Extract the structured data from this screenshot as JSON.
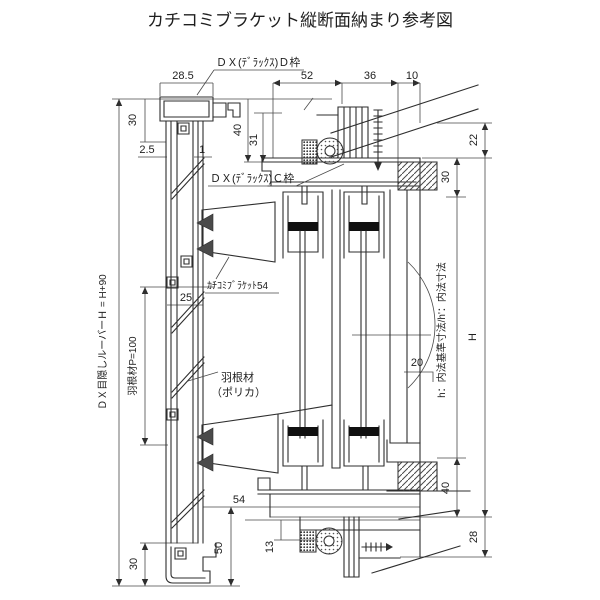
{
  "title": "カチコミブラケット縦断面納まり参考図",
  "colors": {
    "background": "#ffffff",
    "line": "#2e2e2e"
  },
  "labels": {
    "d_frame": "ＤＸ(ﾃﾞﾗｯｸｽ)Ｄ枠",
    "c_frame": "ＤＸ(ﾃﾞﾗｯｸｽ)Ｃ枠",
    "bracket": "ｶﾁｺﾐﾌﾞﾗｹｯﾄ54",
    "blade_line1": "羽根材",
    "blade_line2": "（ポリカ）",
    "louver_height": "ＤＸ目隠しルーバーＨ = H+90",
    "blade_pitch": "羽根材P=100",
    "inner_note": "h：内法基準寸法/h'：内法寸法",
    "height_symbol": "H"
  },
  "dims": {
    "cap_width": "28.5",
    "top_left_30": "30",
    "gap_2_5": "2.5",
    "gap_1": "1",
    "head_40": "40",
    "head_31": "31",
    "top_52": "52",
    "top_36": "36",
    "top_10": "10",
    "right_22": "22",
    "right_30": "30",
    "right_40": "40",
    "right_28": "28",
    "mid_25": "25",
    "arc_20": "20",
    "bottom_54": "54",
    "bottom_50": "50",
    "bottom_13": "13",
    "bottom_left_30": "30"
  }
}
